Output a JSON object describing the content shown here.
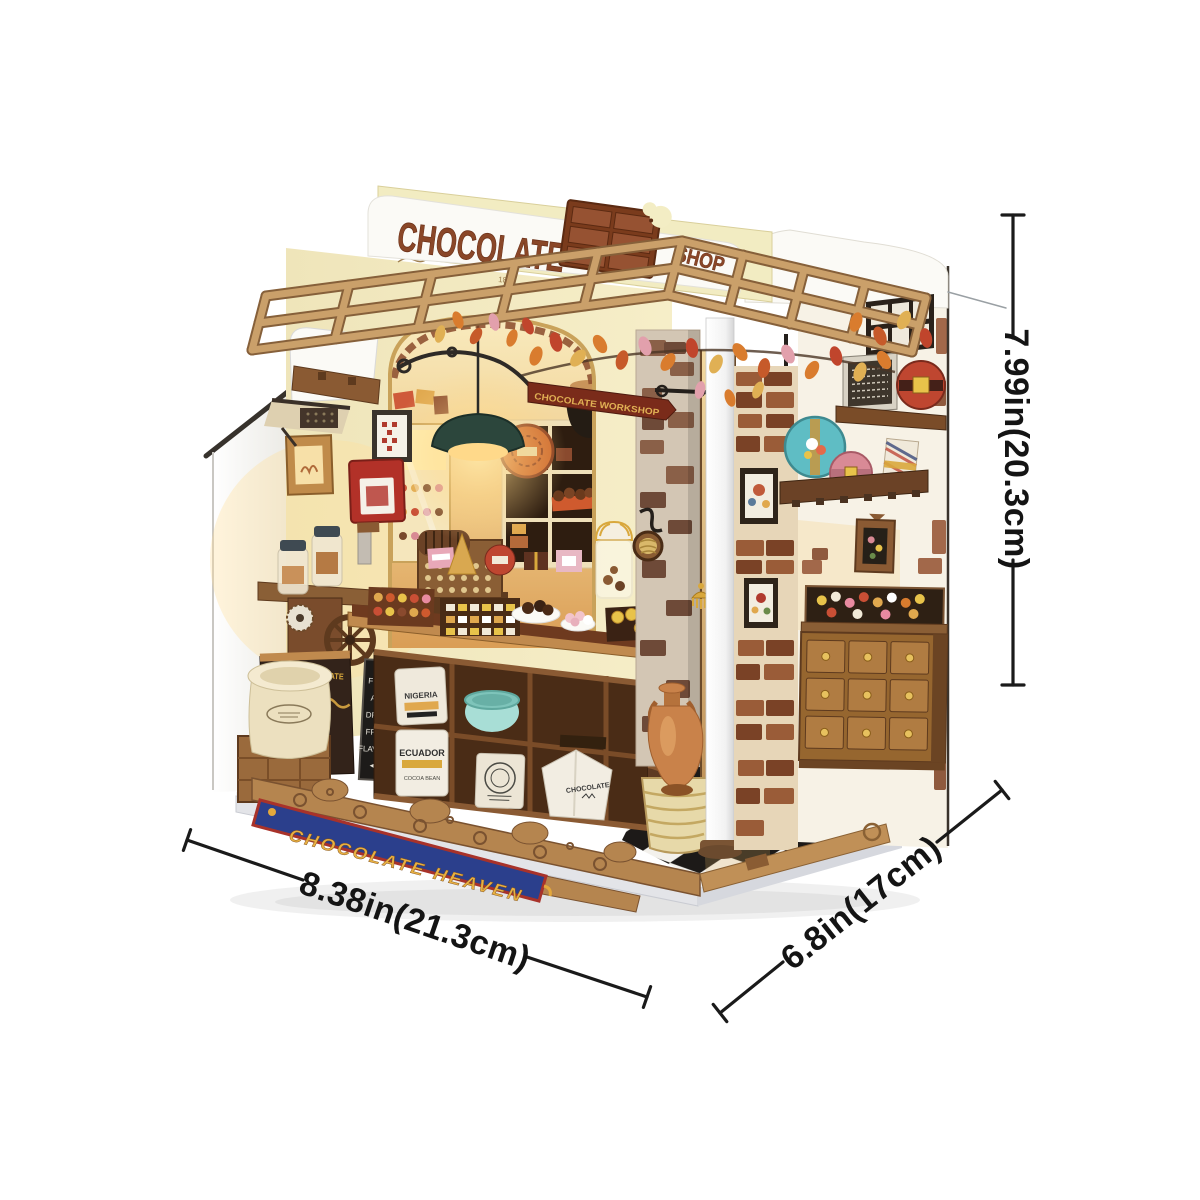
{
  "image_type": "product-photo of DIY miniature chocolate shop kit",
  "background": "#ffffff",
  "model": {
    "kit_name_top_sign": {
      "line": "CHOCOLATE",
      "word_right": "SHOP"
    },
    "hanging_sign_text": "CHOCOLATE WORKSHOP",
    "base_banner_text": "CHOCOLATE HEAVEN",
    "facade_year": "1893",
    "chalkboard_lines": [
      "FRUIT",
      "AND",
      "DRIED",
      "FRUIT",
      "FLAVORS"
    ],
    "dark_cabinet_text": "YULFINA CHOCOLATE",
    "sacks": {
      "sack1": "NIGERIA",
      "sack2_line1": "ECUADOR",
      "sack2_line2": "COCOA BEAN",
      "sack3": "CHOCOLATE"
    }
  },
  "dimensions": {
    "height_label": "7.99in(20.3cm)",
    "width_label": "8.38in(21.3cm)",
    "depth_label": "6.8in(17cm)"
  },
  "colors": {
    "dimension_line": "#1a1a1a",
    "banner_blue": "#2b3f8c",
    "banner_gold": "#e8b042",
    "banner_red_trim": "#a8322a",
    "roof_letter_brown": "#8a4728",
    "pergola_wood": "#caa06a",
    "lamp_green": "#2c463c",
    "teal_tin": "#5fbdc4",
    "pink_tin": "#d98a96",
    "red_tin": "#bf4630",
    "facade_cream": "#f3ecc0",
    "checker_dark": "#1d1a18"
  }
}
